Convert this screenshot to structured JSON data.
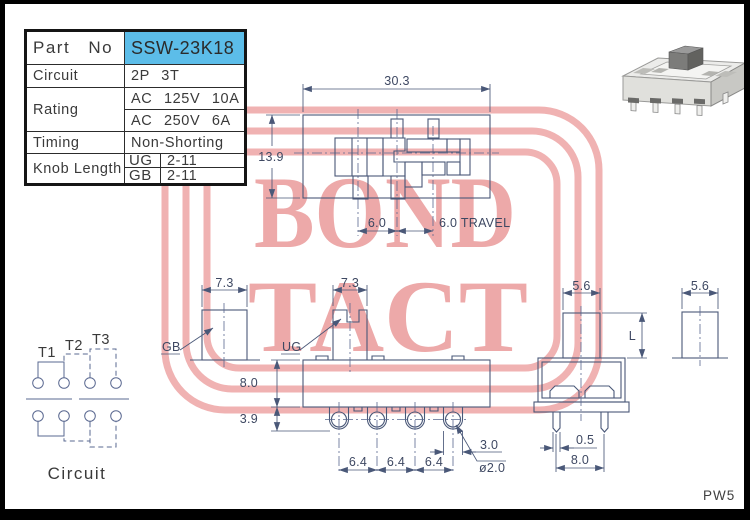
{
  "watermark": {
    "line1": "BOND",
    "line2": "TACT",
    "frame_color": "#f0b2b2",
    "text_color": "#eda9a9"
  },
  "spec_table": {
    "part_no_label": "Part No",
    "part_no_value": "SSW-23K18",
    "circuit_label": "Circuit",
    "circuit_value": "2P 3T",
    "rating_label": "Rating",
    "rating_value_1": "AC 125V 10A",
    "rating_value_2": "AC 250V 6A",
    "timing_label": "Timing",
    "timing_value": "Non-Shorting",
    "knob_length_label": "Knob Length",
    "knob_ug_key": "UG",
    "knob_ug_value": "2-11",
    "knob_gb_key": "GB",
    "knob_gb_value": "2-11"
  },
  "top_view": {
    "dim_width": "30.3",
    "dim_height": "13.9",
    "dim_pos": "6.0",
    "dim_travel": "6.0 TRAVEL"
  },
  "front_view": {
    "knob_dim": "7.3",
    "knob_label": "UG",
    "body_height": "8.0",
    "terminal_length": "3.9",
    "pitch_1": "6.4",
    "pitch_2": "6.4",
    "pitch_3": "6.4",
    "terminal_width": "3.0",
    "hole_dia": "ø2.0"
  },
  "gb_view": {
    "knob_dim": "7.3",
    "knob_label": "GB"
  },
  "side_view": {
    "knob_dim": "5.6",
    "knob_length": "L",
    "leg_width": "0.5",
    "leg_span": "8.0"
  },
  "knob_detail": {
    "dim": "5.6"
  },
  "circuit_diagram": {
    "title": "Circuit",
    "t1": "T1",
    "t2": "T2",
    "t3": "T3"
  },
  "footer": {
    "code": "PW5"
  },
  "colors": {
    "line": "#4a5878",
    "dim_text": "#3e4862",
    "table_text": "#3a3a3a",
    "highlight": "#5cbde9"
  }
}
